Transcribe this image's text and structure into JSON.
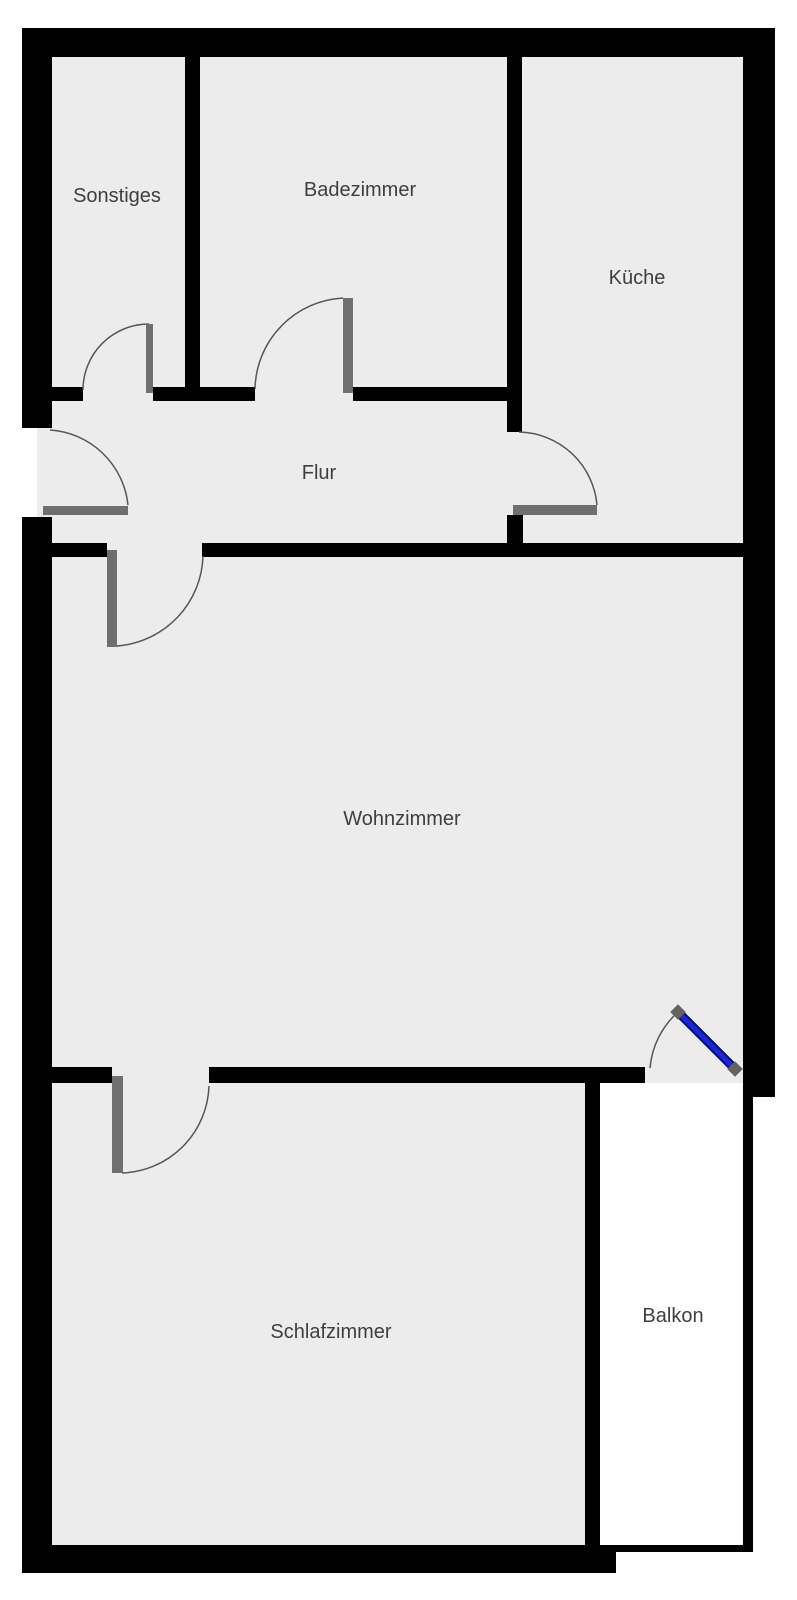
{
  "floorplan": {
    "rooms": [
      {
        "label": "Sonstiges"
      },
      {
        "label": "Badezimmer"
      },
      {
        "label": "Küche"
      },
      {
        "label": "Flur"
      },
      {
        "label": "Wohnzimmer"
      },
      {
        "label": "Schlafzimmer"
      },
      {
        "label": "Balkon"
      }
    ],
    "colors": {
      "wall": "#000000",
      "room_fill": "#ececec",
      "balcony_fill": "#ffffff",
      "outside": "#ffffff",
      "door_panel": "#6f6f6f",
      "door_cap": "#636363",
      "swing_arc": "#55575a",
      "balcony_door": "#2025d2",
      "balcony_door_outline": "#000e7e",
      "label_text": "#3c4043"
    }
  }
}
